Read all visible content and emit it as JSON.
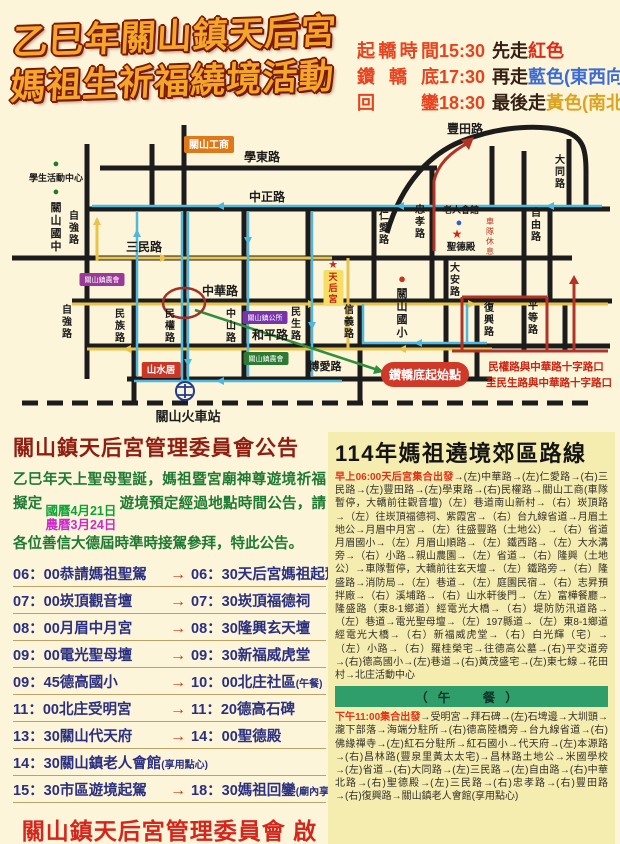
{
  "title": {
    "line1": "乙巳年關山鎮天后宮",
    "line2": "媽祖生祈福繞境活動"
  },
  "schedule_info": {
    "rows": [
      {
        "label": "起轎時間",
        "time": "15:30",
        "walk": "先走",
        "color_word": "紅色"
      },
      {
        "label": "鑽轎底",
        "time": "17:30",
        "walk": "再走",
        "color_word": "藍色(東西向)"
      },
      {
        "label": "回鑾",
        "time": "18:30",
        "walk": "最後走",
        "color_word": "黃色(南北向)"
      }
    ],
    "colors": {
      "red": "#e02a18",
      "blue": "#3b6bd6",
      "yellow": "#dca31e"
    }
  },
  "map": {
    "labels": [
      {
        "t": "學東路",
        "x": 250,
        "y": 40,
        "s": 12,
        "bold": true
      },
      {
        "t": "中正路",
        "x": 255,
        "y": 80,
        "s": 12,
        "bold": true
      },
      {
        "t": "三民路",
        "x": 132,
        "y": 130,
        "s": 12,
        "bold": true
      },
      {
        "t": "中華路",
        "x": 208,
        "y": 174,
        "s": 12,
        "bold": true
      },
      {
        "t": "和平路",
        "x": 258,
        "y": 218,
        "s": 12,
        "bold": true
      },
      {
        "t": "博愛路",
        "x": 313,
        "y": 249,
        "s": 11,
        "bold": true
      },
      {
        "t": "豐田路",
        "x": 453,
        "y": 12,
        "s": 12,
        "bold": true
      },
      {
        "t": "大同路",
        "x": 548,
        "y": 42,
        "s": 10,
        "v": true,
        "bold": true
      },
      {
        "t": "自由路",
        "x": 524,
        "y": 95,
        "s": 10,
        "v": true,
        "bold": true
      },
      {
        "t": "平等路",
        "x": 521,
        "y": 188,
        "s": 10,
        "v": true,
        "bold": true
      },
      {
        "t": "復興路",
        "x": 477,
        "y": 190,
        "s": 10,
        "v": true,
        "bold": true
      },
      {
        "t": "大安路",
        "x": 443,
        "y": 150,
        "s": 10,
        "v": true,
        "bold": true
      },
      {
        "t": "忠孝路",
        "x": 408,
        "y": 92,
        "s": 10,
        "v": true,
        "bold": true
      },
      {
        "t": "仁愛路",
        "x": 372,
        "y": 98,
        "s": 10,
        "v": true,
        "bold": true
      },
      {
        "t": "信義路",
        "x": 337,
        "y": 192,
        "s": 10,
        "v": true,
        "bold": true
      },
      {
        "t": "民生路",
        "x": 284,
        "y": 194,
        "s": 10,
        "v": true,
        "bold": true
      },
      {
        "t": "中山路",
        "x": 219,
        "y": 196,
        "s": 10,
        "v": true,
        "bold": true
      },
      {
        "t": "民權路",
        "x": 158,
        "y": 196,
        "s": 10,
        "v": true,
        "bold": true
      },
      {
        "t": "民族路",
        "x": 108,
        "y": 196,
        "s": 10,
        "v": true,
        "bold": true
      },
      {
        "t": "自強路",
        "x": 62,
        "y": 98,
        "s": 10,
        "v": true,
        "bold": true
      },
      {
        "t": "自強路",
        "x": 55,
        "y": 192,
        "s": 10,
        "v": true,
        "bold": true
      },
      {
        "t": "學生活動中心",
        "x": 44,
        "y": 60,
        "s": 9,
        "bold": true,
        "name": "student-activity-center-label"
      },
      {
        "t": "●",
        "x": 44,
        "y": 46,
        "s": 11,
        "c": "#1e7a2e",
        "name": "student-activity-center-dot"
      },
      {
        "t": "關山國中",
        "x": 44,
        "y": 90,
        "s": 11,
        "v": true,
        "bold": true,
        "name": "guanshan-junior-high-label"
      },
      {
        "t": "●",
        "x": 44,
        "y": 74,
        "s": 11,
        "c": "#1e7a2e",
        "name": "guanshan-junior-high-dot"
      },
      {
        "t": "關山國小",
        "x": 390,
        "y": 176,
        "s": 11,
        "v": true,
        "bold": true,
        "name": "guanshan-elementary-label"
      },
      {
        "t": "●",
        "x": 390,
        "y": 162,
        "s": 13,
        "c": "#cc3322",
        "name": "guanshan-elementary-dot"
      },
      {
        "t": "老人會館",
        "x": 449,
        "y": 92,
        "s": 9,
        "bold": true,
        "name": "senior-center-label"
      },
      {
        "t": "●",
        "x": 447,
        "y": 105,
        "s": 11,
        "c": "#2a5fd0",
        "name": "senior-center-dot"
      },
      {
        "t": "★",
        "x": 445,
        "y": 117,
        "s": 12,
        "c": "#d02818",
        "name": "shengde-hall-star"
      },
      {
        "t": "聖德殿",
        "x": 449,
        "y": 129,
        "s": 9.5,
        "bold": true,
        "name": "shengde-hall-label"
      },
      {
        "t": "車隊休息",
        "x": 478,
        "y": 103,
        "s": 8,
        "v": true,
        "c": "#c03020",
        "name": "convoy-rest-label"
      },
      {
        "t": "★",
        "x": 321,
        "y": 147,
        "s": 11,
        "c": "#d02818",
        "name": "tianhou-temple-star"
      },
      {
        "t": "天后宮",
        "x": 321,
        "y": 159,
        "s": 9,
        "v": true,
        "c": "#c22210",
        "b": "#f6dd66",
        "bold": true,
        "name": "tianhou-temple-label"
      },
      {
        "t": "關山工商",
        "x": 197,
        "y": 27,
        "s": 10,
        "c": "#ffffff",
        "b": "#e07818",
        "bold": true,
        "name": "guanshan-vocational-label"
      },
      {
        "t": "山水居",
        "x": 149,
        "y": 252,
        "s": 9.5,
        "c": "#ffffff",
        "b": "#cc3626",
        "bold": true,
        "name": "shanshuiju-label"
      },
      {
        "t": "關山鎮農會",
        "x": 90,
        "y": 161,
        "s": 7,
        "c": "#ffffff",
        "b": "#993a99",
        "name": "farmers-association-label"
      },
      {
        "t": "關山鎮公所",
        "x": 253,
        "y": 199,
        "s": 7,
        "c": "#ffffff",
        "b": "#7733aa",
        "name": "town-office-label"
      },
      {
        "t": "關山鎮農會",
        "x": 254,
        "y": 240,
        "s": 7,
        "c": "#ffffff",
        "b": "#2e7a35",
        "name": "farmers-association-south-label"
      },
      {
        "t": "關山火車站",
        "x": 176,
        "y": 300,
        "s": 13,
        "bold": true,
        "name": "train-station-label"
      },
      {
        "t": "鑽轎底起始點",
        "x": 413,
        "y": 258,
        "s": 12,
        "c": "#ffffff",
        "b": "#d03828",
        "bold": true,
        "pill": true,
        "name": "palanquin-start-label"
      },
      {
        "t": "民權路與中華路十字路口",
        "x": 534,
        "y": 249,
        "s": 10.5,
        "c": "#cc2211",
        "bold": true,
        "name": "start-note-line1"
      },
      {
        "t": "至民生路與中華路十字路口",
        "x": 537,
        "y": 265,
        "s": 10.5,
        "c": "#cc2211",
        "bold": true,
        "name": "start-note-line2"
      }
    ]
  },
  "announcement": {
    "title": "關山鎮天后宮管理委員會公告",
    "p1": "乙巳年天上聖母聖誕，媽祖暨宮廟神尊遊境祈福擬定",
    "date_solar": "國曆4月21日",
    "date_lunar": "農曆3月24日",
    "p2": "遊境預定經過地點時間公告，請各位善信大德屆時準時接駕參拜，特此公告。",
    "footer": "關山鎮天后宮管理委員會 啟"
  },
  "schedule": {
    "rows": [
      {
        "t1": "06：00",
        "n1": "恭請媽祖聖駕",
        "note1": "",
        "arrow": "→",
        "t2": "06：30",
        "n2": "天后宮媽祖起駕",
        "note2": ""
      },
      {
        "t1": "07：00",
        "n1": "崁頂觀音壇",
        "note1": "",
        "arrow": "→",
        "t2": "07：30",
        "n2": "崁頂福德祠",
        "note2": ""
      },
      {
        "t1": "08：00",
        "n1": "月眉中月宮",
        "note1": "",
        "arrow": "→",
        "t2": "08：30",
        "n2": "隆興玄天壇",
        "note2": ""
      },
      {
        "t1": "09：00",
        "n1": "電光聖母壇",
        "note1": "",
        "arrow": "→",
        "t2": "09：30",
        "n2": "新福威虎堂",
        "note2": ""
      },
      {
        "t1": "09：45",
        "n1": "德高國小",
        "note1": "",
        "arrow": "→",
        "t2": "10：00",
        "n2": "北庄社區",
        "note2": "(午餐)"
      },
      {
        "t1": "11：00",
        "n1": "北庄受明宮",
        "note1": "",
        "arrow": "→",
        "t2": "11：20",
        "n2": "德高石碑",
        "note2": ""
      },
      {
        "t1": "13：30",
        "n1": "關山代天府",
        "note1": "",
        "arrow": "→",
        "t2": "14：00",
        "n2": "聖德殿",
        "note2": ""
      },
      {
        "t1": "14：30",
        "n1": "關山鎮老人會館",
        "note1": "(享用點心)",
        "arrow": "",
        "t2": "",
        "n2": "",
        "note2": ""
      },
      {
        "t1": "15：30",
        "n1": "市區遊境起駕",
        "note1": "",
        "arrow": "→",
        "t2": "18：30",
        "n2": "媽祖回鑾",
        "note2": "(廟內享用平安宴)"
      }
    ]
  },
  "route": {
    "title": "114年媽祖遶境郊區路線",
    "morning_lead": "早上06:00天后宮集合出發",
    "morning": "→(左)中華路→(左)仁愛路→(右)三民路→(左)豐田路→(左)學東路→(右)民權路→關山工商(車隊暫停，大轎前往觀音壇)（左）巷道南山新村→（右）崁頂路→（左）往崁頂福德祠、紫霞宮→（右）台九線省道→月眉土地公→月眉中月宮→（左）往盛豐路（土地公）→（右）省道月眉國小→（左）月眉山順路→（左）鐵西路→（左）大水溝旁→（右）小路→親山農園→（左）省道→（右）隆興（土地公）→車隊暫停，大轎前往玄天壇→（左）鐵路旁→（右）隆盛路→消防局→（左）巷道→（左）庭園民宿→（右）志昇預拌廠→（右）溪埔路→（右）山水軒後門→（左）富樺餐廳→隆盛路（東8-1鄉道）經電光大橋→（右）堤防防汛道路→（左）巷道→電光聖母壇→（左）197縣道→（左）東8-1鄉道經電光大橋→（右）新福威虎堂→（右）白光輝（宅）→（左）小路→（右）羅桂榮宅→往德高公墓→(右)平交道旁→(右)德高國小→(左)巷道→(右)黃茂盛宅→(左)東七線→花田村→北庄活動中心",
    "lunch": "（午　餐）",
    "afternoon_lead": "下午11:00集合出發",
    "afternoon": "→受明宮→拜石碑→(左)石埤邊→大圳頭→瀧下部落→海端分駐所→(右)德高陸橋旁→台九線省道→(右)佛緣禪寺→(左)紅石分駐所→紅石國小→代天府→(左)本源路→(右)昌林路(豐泉里黃太太宅)→昌林路土地公→米國學校→(左)省道→(右)大同路→(左)三民路→(左)自由路→(右)中華北路→(右)聖德殿→(左)三民路→(右)忠孝路→(右)豐田路→(右)復興路→關山鎮老人會館(享用點心)"
  }
}
